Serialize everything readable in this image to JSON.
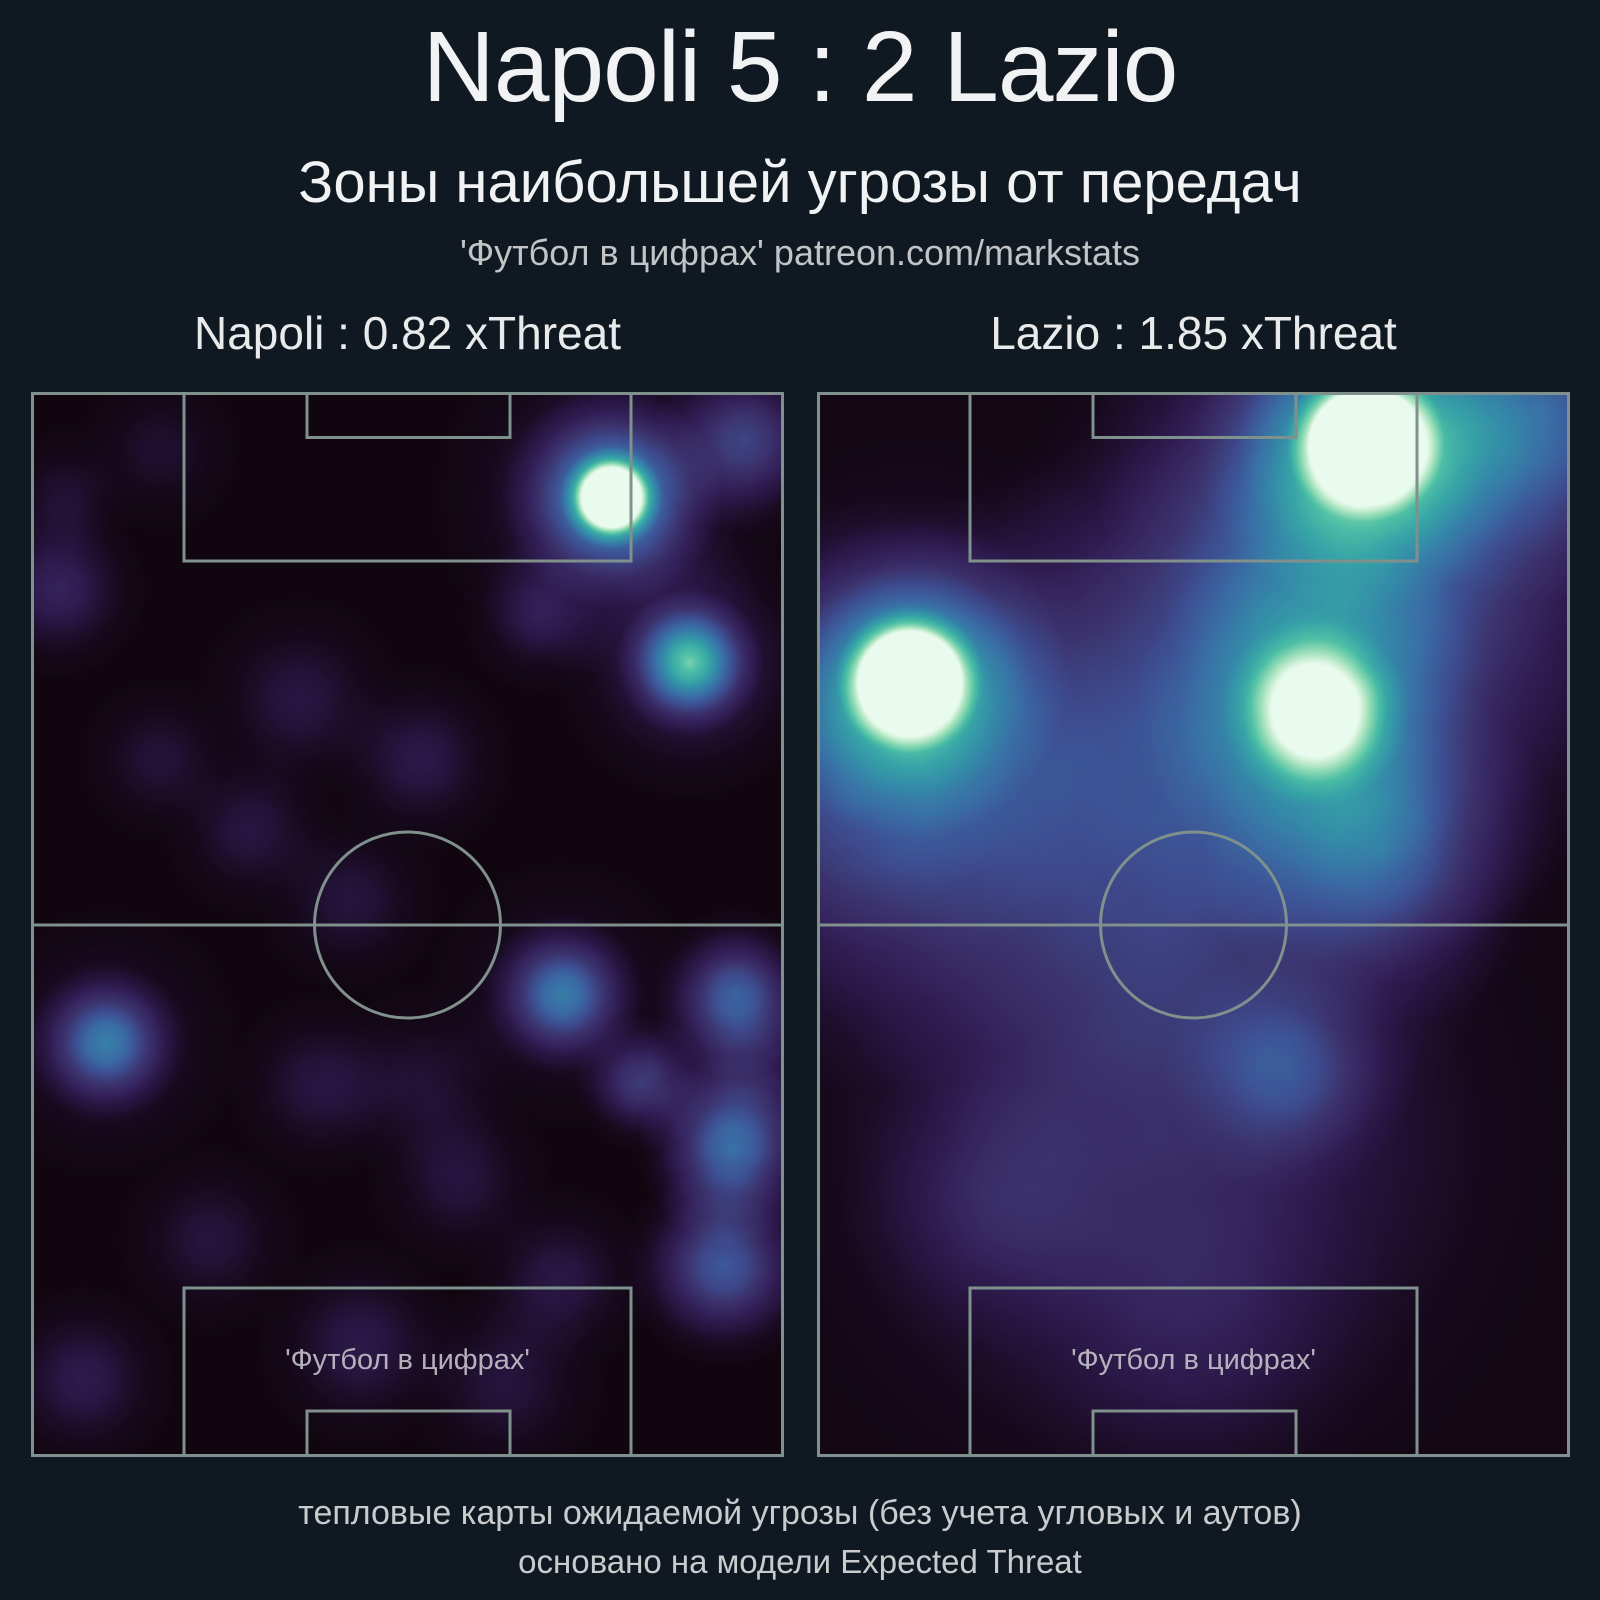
{
  "page": {
    "title": "Napoli 5 : 2 Lazio",
    "subtitle": "Зоны наибольшей угрозы от передач",
    "attribution": "'Футбол в цифрах' patreon.com/markstats"
  },
  "panels": [
    {
      "team": "Napoli",
      "title": "Napoli : 0.82 xThreat",
      "watermark": "'Футбол в цифрах'"
    },
    {
      "team": "Lazio",
      "title": "Lazio : 1.85 xThreat",
      "watermark": "'Футбол в цифрах'"
    }
  ],
  "footer": {
    "line1": "тепловые карты ожидаемой угрозы (без учета угловых и аутов)",
    "line2": "основано на модели Expected Threat"
  },
  "colors": {
    "background": "#101922",
    "pitch_line": "#80908c",
    "text_primary": "#f1f2f3",
    "text_secondary": "#c9cbcd",
    "watermark": "#c6c2ca",
    "colormap": [
      [
        0.0,
        "#0c0406"
      ],
      [
        0.08,
        "#16091b"
      ],
      [
        0.16,
        "#271540"
      ],
      [
        0.24,
        "#35235d"
      ],
      [
        0.32,
        "#3c346f"
      ],
      [
        0.42,
        "#3d4f92"
      ],
      [
        0.52,
        "#3a6da5"
      ],
      [
        0.62,
        "#3489a8"
      ],
      [
        0.72,
        "#37a5a7"
      ],
      [
        0.8,
        "#4fc0a6"
      ],
      [
        0.88,
        "#8cdab4"
      ],
      [
        0.95,
        "#c9eed2"
      ],
      [
        1.0,
        "#e8fbee"
      ]
    ]
  },
  "chart_data": [
    {
      "type": "heatmap",
      "team": "Napoli",
      "xthreat": 0.82,
      "base": 0.04,
      "points": [
        {
          "x": 0.771,
          "y": 0.099,
          "r": 0.048,
          "i": 1.0
        },
        {
          "x": 0.771,
          "y": 0.099,
          "r": 0.105,
          "i": 0.55
        },
        {
          "x": 0.771,
          "y": 0.099,
          "r": 0.17,
          "i": 0.2
        },
        {
          "x": 0.875,
          "y": 0.254,
          "r": 0.07,
          "i": 0.6
        },
        {
          "x": 0.875,
          "y": 0.254,
          "r": 0.13,
          "i": 0.22
        },
        {
          "x": 0.95,
          "y": 0.045,
          "r": 0.09,
          "i": 0.32
        },
        {
          "x": 0.676,
          "y": 0.209,
          "r": 0.075,
          "i": 0.16
        },
        {
          "x": 0.036,
          "y": 0.185,
          "r": 0.085,
          "i": 0.2
        },
        {
          "x": 0.045,
          "y": 0.1,
          "r": 0.07,
          "i": 0.1
        },
        {
          "x": 0.357,
          "y": 0.289,
          "r": 0.1,
          "i": 0.13
        },
        {
          "x": 0.517,
          "y": 0.345,
          "r": 0.09,
          "i": 0.15
        },
        {
          "x": 0.291,
          "y": 0.411,
          "r": 0.085,
          "i": 0.13
        },
        {
          "x": 0.171,
          "y": 0.345,
          "r": 0.08,
          "i": 0.11
        },
        {
          "x": 0.424,
          "y": 0.477,
          "r": 0.09,
          "i": 0.12
        },
        {
          "x": 0.706,
          "y": 0.566,
          "r": 0.075,
          "i": 0.42
        },
        {
          "x": 0.706,
          "y": 0.566,
          "r": 0.13,
          "i": 0.13
        },
        {
          "x": 0.935,
          "y": 0.564,
          "r": 0.08,
          "i": 0.4
        },
        {
          "x": 0.95,
          "y": 0.63,
          "r": 0.1,
          "i": 0.2
        },
        {
          "x": 0.811,
          "y": 0.649,
          "r": 0.065,
          "i": 0.3
        },
        {
          "x": 0.931,
          "y": 0.712,
          "r": 0.09,
          "i": 0.48
        },
        {
          "x": 0.92,
          "y": 0.82,
          "r": 0.095,
          "i": 0.42
        },
        {
          "x": 0.1,
          "y": 0.611,
          "r": 0.075,
          "i": 0.42
        },
        {
          "x": 0.1,
          "y": 0.611,
          "r": 0.13,
          "i": 0.14
        },
        {
          "x": 0.069,
          "y": 0.927,
          "r": 0.09,
          "i": 0.16
        },
        {
          "x": 0.437,
          "y": 0.895,
          "r": 0.1,
          "i": 0.15
        },
        {
          "x": 0.238,
          "y": 0.796,
          "r": 0.09,
          "i": 0.12
        },
        {
          "x": 0.702,
          "y": 0.834,
          "r": 0.09,
          "i": 0.14
        },
        {
          "x": 0.57,
          "y": 0.74,
          "r": 0.09,
          "i": 0.12
        },
        {
          "x": 0.384,
          "y": 0.651,
          "r": 0.09,
          "i": 0.13
        },
        {
          "x": 0.171,
          "y": 0.054,
          "r": 0.08,
          "i": 0.09
        },
        {
          "x": 0.52,
          "y": 0.65,
          "r": 0.1,
          "i": 0.1
        },
        {
          "x": 0.63,
          "y": 0.93,
          "r": 0.1,
          "i": 0.12
        }
      ]
    },
    {
      "type": "heatmap",
      "team": "Lazio",
      "xthreat": 1.85,
      "base": 0.05,
      "points": [
        {
          "x": 0.7,
          "y": 0.2,
          "r": 0.34,
          "i": 0.42
        },
        {
          "x": 0.45,
          "y": 0.4,
          "r": 0.36,
          "i": 0.3
        },
        {
          "x": 0.45,
          "y": 0.7,
          "r": 0.4,
          "i": 0.22
        },
        {
          "x": 0.05,
          "y": 0.38,
          "r": 0.28,
          "i": 0.28
        },
        {
          "x": 0.96,
          "y": 0.02,
          "r": 0.18,
          "i": 0.38
        },
        {
          "x": 0.75,
          "y": 0.43,
          "r": 0.17,
          "i": 0.3
        },
        {
          "x": 0.728,
          "y": 0.047,
          "r": 0.075,
          "i": 1.0
        },
        {
          "x": 0.728,
          "y": 0.047,
          "r": 0.16,
          "i": 0.5
        },
        {
          "x": 0.728,
          "y": 0.06,
          "r": 0.26,
          "i": 0.2
        },
        {
          "x": 0.123,
          "y": 0.27,
          "r": 0.07,
          "i": 1.0
        },
        {
          "x": 0.123,
          "y": 0.27,
          "r": 0.15,
          "i": 0.5
        },
        {
          "x": 0.13,
          "y": 0.28,
          "r": 0.25,
          "i": 0.2
        },
        {
          "x": 0.661,
          "y": 0.3,
          "r": 0.09,
          "i": 0.55
        },
        {
          "x": 0.661,
          "y": 0.3,
          "r": 0.17,
          "i": 0.25
        },
        {
          "x": 0.628,
          "y": 0.637,
          "r": 0.12,
          "i": 0.22
        },
        {
          "x": 0.24,
          "y": 0.76,
          "r": 0.15,
          "i": 0.12
        },
        {
          "x": 0.5,
          "y": 0.88,
          "r": 0.2,
          "i": 0.08
        }
      ]
    }
  ]
}
